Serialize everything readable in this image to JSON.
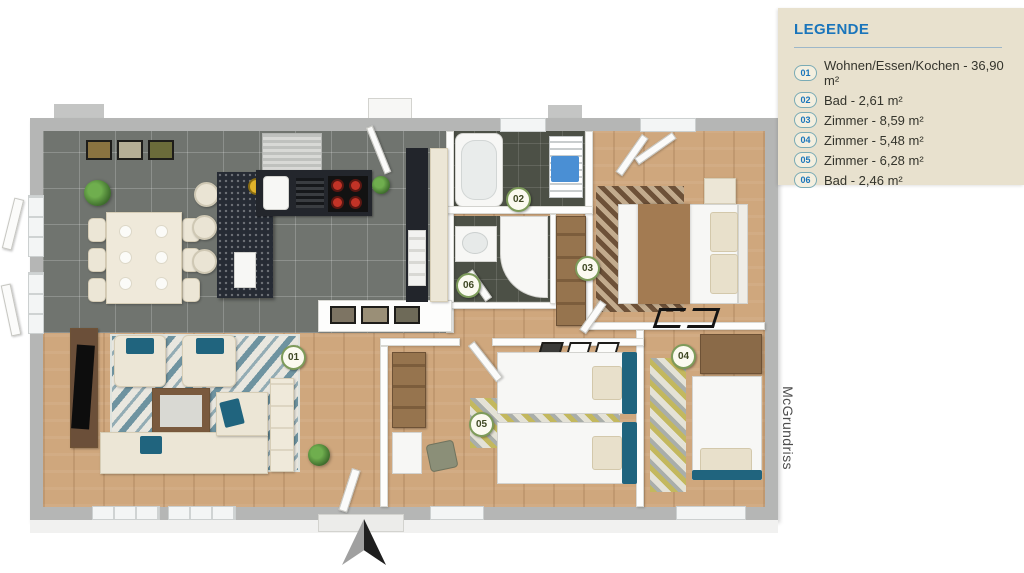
{
  "legend": {
    "title": "LEGENDE",
    "items": [
      {
        "num": "01",
        "label": "Wohnen/Essen/Kochen - 36,90 m²"
      },
      {
        "num": "02",
        "label": "Bad - 2,61 m²"
      },
      {
        "num": "03",
        "label": "Zimmer - 8,59 m²"
      },
      {
        "num": "04",
        "label": "Zimmer - 5,48 m²"
      },
      {
        "num": "05",
        "label": "Zimmer - 6,28 m²"
      },
      {
        "num": "06",
        "label": "Bad - 2,46 m²"
      }
    ]
  },
  "plan": {
    "watermark": "McGrundriss",
    "badges": [
      {
        "id": "01"
      },
      {
        "id": "02"
      },
      {
        "id": "03"
      },
      {
        "id": "04"
      },
      {
        "id": "05"
      },
      {
        "id": "06"
      }
    ]
  },
  "colors": {
    "legend_bg": "#e8e1ce",
    "accent_blue": "#1a75bb",
    "wall_grey": "#b5b6b5",
    "wood_floor": "#cfa77d",
    "kitchen_tile": "#70746f",
    "bath_floor": "#4c5046",
    "teal_accent": "#20647e",
    "blanket_brown": "#a37b52",
    "badge_border_green": "#7d9b5a"
  }
}
